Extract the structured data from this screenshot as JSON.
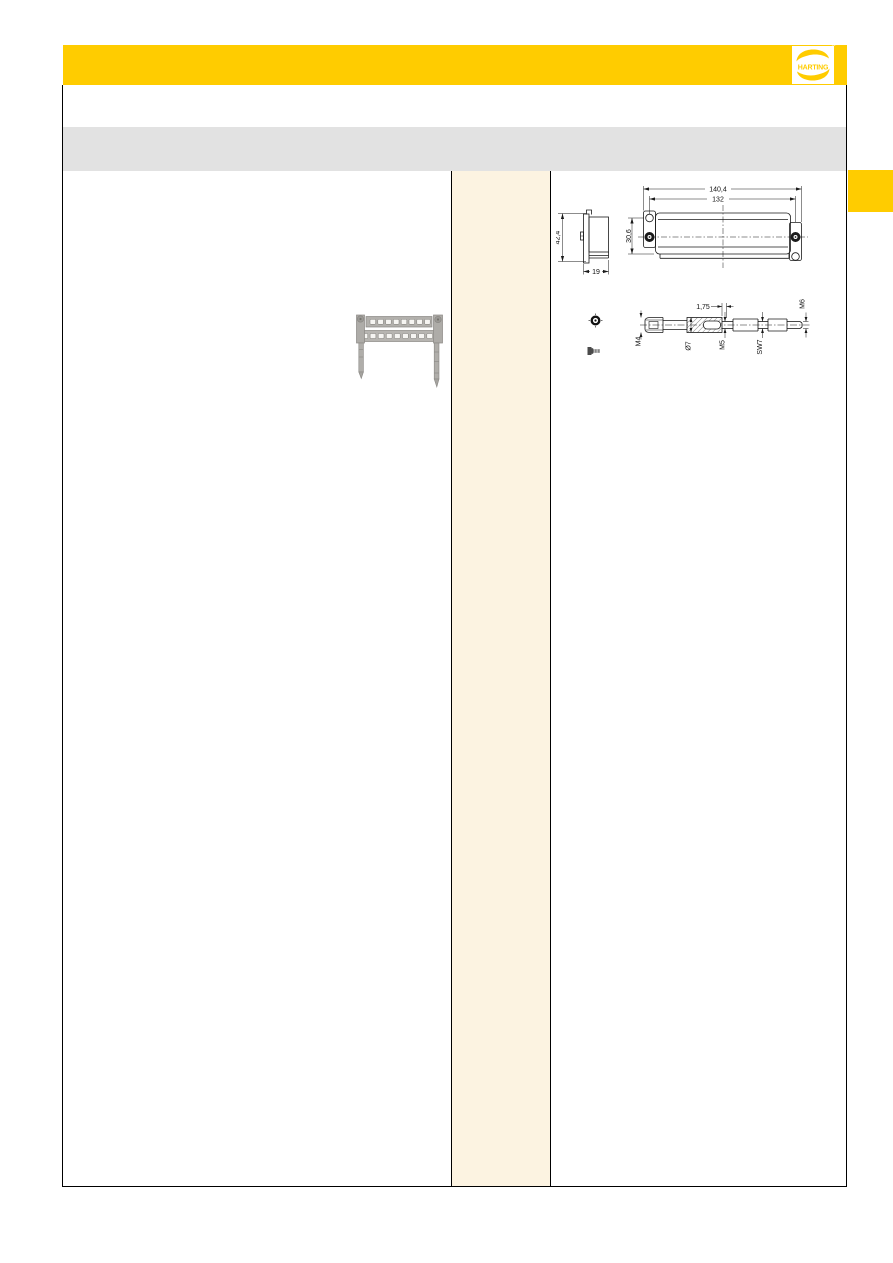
{
  "page": {
    "colors": {
      "brand_yellow": "#FFCC00",
      "gray_band": "#E2E2E2",
      "cream_column": "#FCF3E1",
      "rule_line": "#000000"
    }
  },
  "header": {
    "logo": {
      "text": "HARTING",
      "registered": "®"
    }
  },
  "content": {
    "product_photo": {
      "name": "docking-frame-with-guide-pins-photo"
    },
    "drawings": {
      "hood_views": {
        "overall_width": "140,4",
        "fixing_centers": "132",
        "front_height": "30,6",
        "side_height": "42,4",
        "side_depth": "19"
      },
      "guide_pin": {
        "thread_tip": "M4",
        "pitch": "1,75",
        "shank_diameter": "Ø7",
        "thread_middle": "M5",
        "wrench_size": "SW7",
        "thread_end": "M6"
      }
    }
  }
}
